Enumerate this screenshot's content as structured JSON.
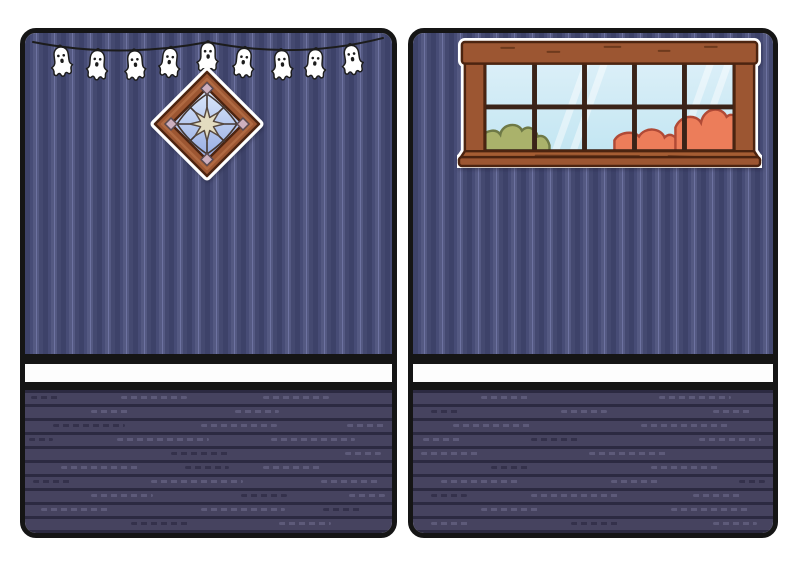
{
  "page": {
    "background_color": "#ffffff",
    "panel_count": 2
  },
  "palette": {
    "page_bg": "#ffffff",
    "border_black": "#151515",
    "line_black": "#1c1c1c",
    "wall_dark": "#3d4269",
    "wall_mid": "#474c76",
    "wall_light": "#545982",
    "wall_hl": "#6d72a0",
    "wall_base": "#444970",
    "strip_white": "#fdfdfd",
    "floor_plank": "#46435f",
    "floor_gap": "#2c2a41",
    "floor_dash_light": "#5d5a79",
    "floor_dash_dark": "#34314b",
    "ghost_white": "#ffffff",
    "frame_brown": "#9c5632",
    "frame_dark": "#4c2410",
    "frame_light": "#b06a42",
    "frame_grain": "#6e3a1d",
    "sill_brown": "#a55d33",
    "glass_top": "#dbeff8",
    "glass_bottom": "#c3e6f2",
    "mullion": "#3a2318",
    "bush_green": "#aab26b",
    "bush_green_line": "#6e7946",
    "bush_orange": "#ec7d5a",
    "bush_orange_line": "#b04a36",
    "diamond_glass_top": "#dde9fb",
    "diamond_glass_bottom": "#94aae2",
    "leading": "#433630",
    "star_cream": "#e3dcc0",
    "star_line": "#57493f",
    "pane_pink": "#cdb0bf",
    "pane_pink_line": "#5a4a50"
  },
  "left_room": {
    "name": "halloween-wall-room",
    "stickers": [
      "ghost-garland",
      "diamond-window"
    ],
    "garland": {
      "ghost_count": 9,
      "ghost_x": [
        35,
        73,
        109,
        146,
        183,
        220,
        256,
        291,
        325
      ],
      "ghost_rot": [
        -7,
        4,
        -5,
        6,
        0,
        6,
        -5,
        4,
        -9
      ],
      "ghost_flip": [
        false,
        true,
        false,
        true,
        false,
        true,
        false,
        true,
        false
      ],
      "ghost_scale": 0.66
    },
    "floor_dashes": [
      [
        0,
        6,
        28,
        "d"
      ],
      [
        0,
        96,
        66,
        "l"
      ],
      [
        0,
        238,
        66,
        "l"
      ],
      [
        1,
        66,
        40,
        "l"
      ],
      [
        1,
        210,
        44,
        "l"
      ],
      [
        2,
        28,
        72,
        "d"
      ],
      [
        2,
        176,
        76,
        "l"
      ],
      [
        2,
        322,
        40,
        "l"
      ],
      [
        3,
        4,
        24,
        "d"
      ],
      [
        3,
        92,
        92,
        "l"
      ],
      [
        3,
        246,
        84,
        "l"
      ],
      [
        4,
        146,
        60,
        "d"
      ],
      [
        4,
        320,
        36,
        "l"
      ],
      [
        5,
        36,
        80,
        "l"
      ],
      [
        5,
        160,
        44,
        "d"
      ],
      [
        5,
        238,
        60,
        "l"
      ],
      [
        6,
        8,
        40,
        "d"
      ],
      [
        6,
        126,
        92,
        "l"
      ],
      [
        6,
        296,
        60,
        "l"
      ],
      [
        7,
        66,
        62,
        "l"
      ],
      [
        7,
        216,
        46,
        "d"
      ],
      [
        7,
        324,
        36,
        "l"
      ],
      [
        8,
        16,
        70,
        "l"
      ],
      [
        8,
        176,
        84,
        "l"
      ],
      [
        8,
        298,
        40,
        "d"
      ],
      [
        9,
        106,
        60,
        "d"
      ],
      [
        9,
        254,
        52,
        "l"
      ]
    ]
  },
  "right_room": {
    "name": "window-wall-room",
    "stickers": [
      "wide-window"
    ],
    "window": {
      "cols": 5,
      "rows": 2,
      "bushes": [
        "green-left",
        "orange-right"
      ]
    },
    "floor_dashes": [
      [
        0,
        68,
        50,
        "l"
      ],
      [
        0,
        246,
        72,
        "l"
      ],
      [
        1,
        18,
        30,
        "d"
      ],
      [
        1,
        148,
        46,
        "l"
      ],
      [
        1,
        300,
        40,
        "l"
      ],
      [
        2,
        40,
        80,
        "l"
      ],
      [
        2,
        228,
        90,
        "l"
      ],
      [
        3,
        10,
        40,
        "l"
      ],
      [
        3,
        118,
        50,
        "d"
      ],
      [
        3,
        286,
        62,
        "l"
      ],
      [
        4,
        8,
        60,
        "l"
      ],
      [
        4,
        176,
        80,
        "l"
      ],
      [
        5,
        78,
        40,
        "d"
      ],
      [
        5,
        238,
        70,
        "l"
      ],
      [
        6,
        28,
        80,
        "l"
      ],
      [
        6,
        198,
        50,
        "l"
      ],
      [
        6,
        326,
        26,
        "d"
      ],
      [
        7,
        18,
        36,
        "d"
      ],
      [
        7,
        118,
        90,
        "l"
      ],
      [
        7,
        280,
        50,
        "l"
      ],
      [
        8,
        68,
        60,
        "l"
      ],
      [
        8,
        258,
        80,
        "l"
      ],
      [
        9,
        18,
        40,
        "l"
      ],
      [
        9,
        158,
        50,
        "d"
      ],
      [
        9,
        300,
        44,
        "l"
      ]
    ]
  }
}
